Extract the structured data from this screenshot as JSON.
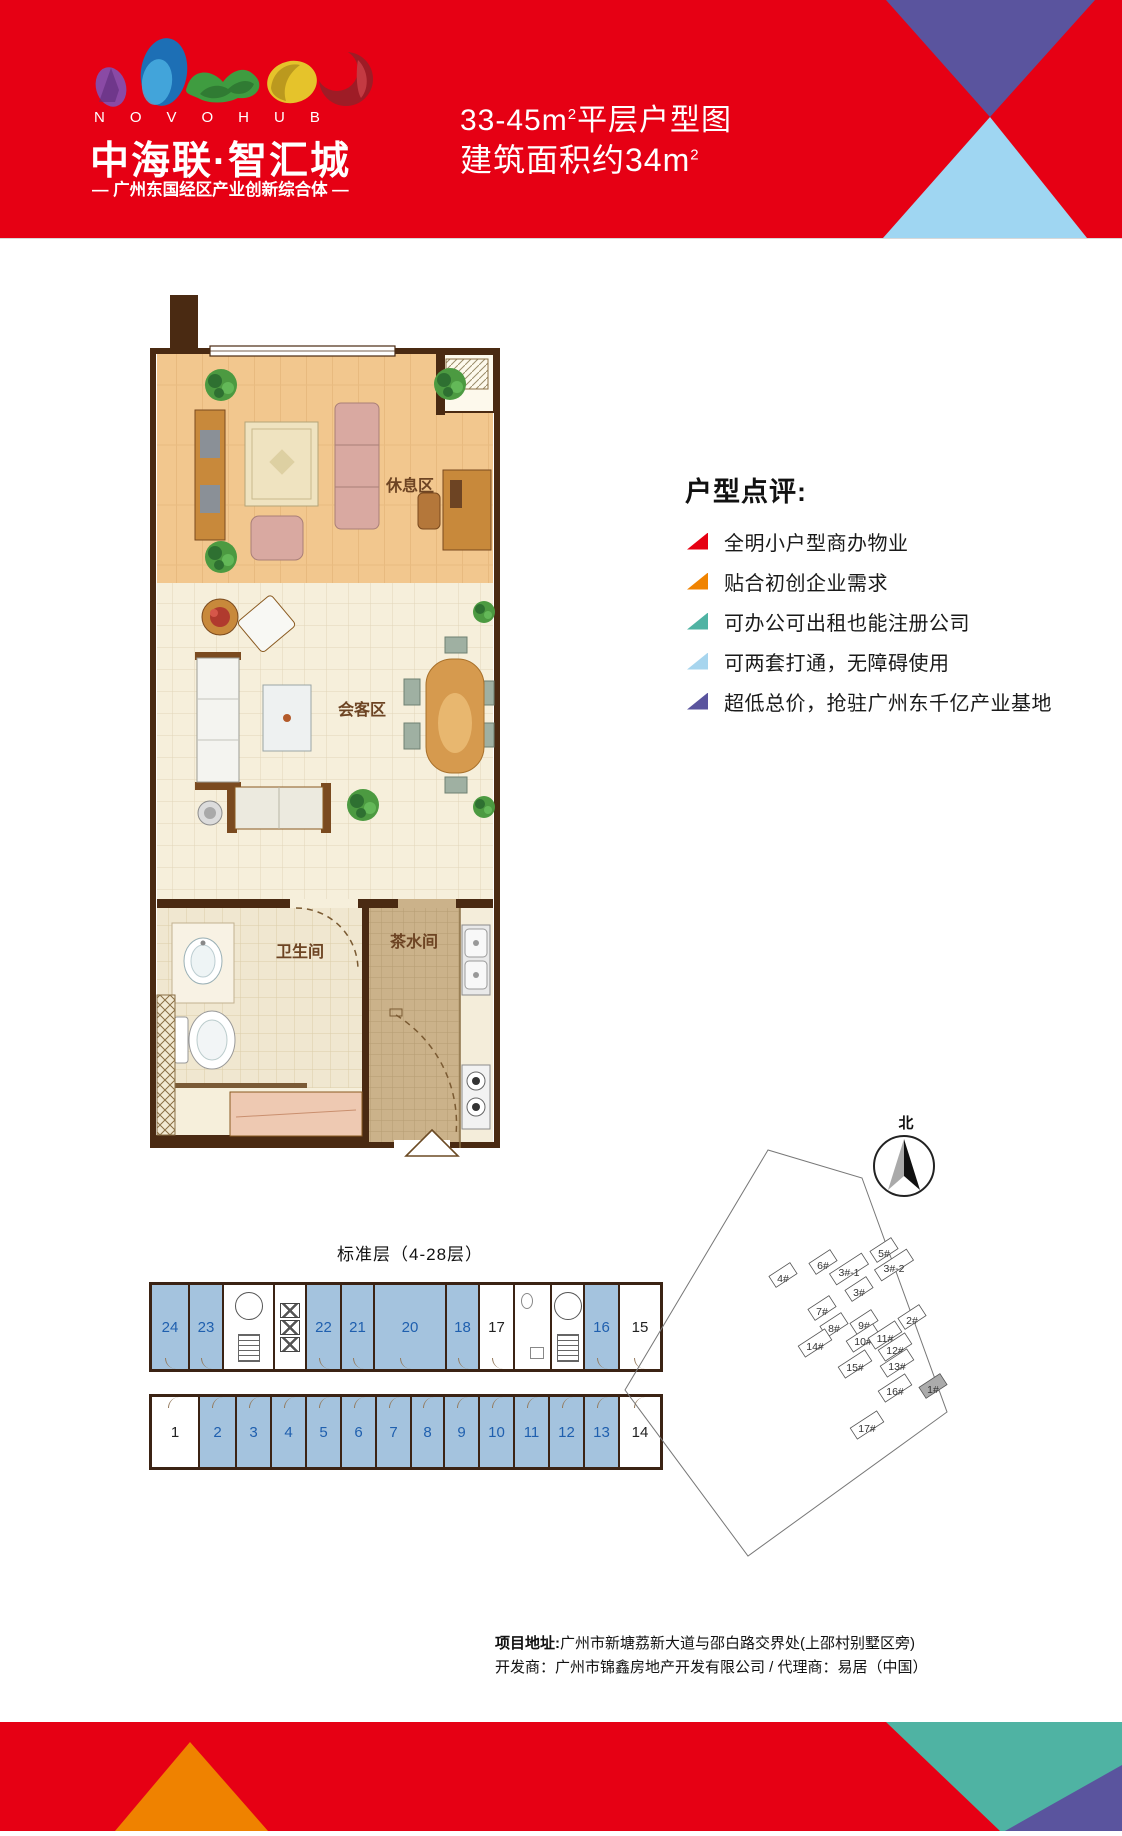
{
  "header": {
    "logo": {
      "letters": "NOVOHUB",
      "name": "中海联·智汇城",
      "tagline": "— 广州东国经区产业创新综合体 —"
    },
    "title": {
      "line1_text": "33-45m",
      "line1_sup": "2",
      "line1_tail": "平层户型图",
      "line2_text": "建筑面积约34m",
      "line2_sup": "2"
    }
  },
  "floor_plan": {
    "rooms": {
      "rest_area": "休息区",
      "meeting_area": "会客区",
      "bathroom": "卫生间",
      "tea_room": "茶水间"
    }
  },
  "comments": {
    "heading": "户型点评:",
    "items": [
      {
        "text": "全明小户型商办物业",
        "color": "#e60012"
      },
      {
        "text": "贴合初创企业需求",
        "color": "#f08300"
      },
      {
        "text": "可办公可出租也能注册公司",
        "color": "#4fb3a3"
      },
      {
        "text": "可两套打通，无障碍使用",
        "color": "#a7d5ee"
      },
      {
        "text": "超低总价，抢驻广州东千亿产业基地",
        "color": "#5a549e"
      }
    ]
  },
  "standard_floor": {
    "title": "标准层（4-28层）",
    "highlight_color": "#a4c3de",
    "number_color": "#1f5fae",
    "top_units": [
      {
        "no": "24",
        "highlight": true
      },
      {
        "no": "23",
        "highlight": true
      },
      {
        "no": "22",
        "highlight": true
      },
      {
        "no": "21",
        "highlight": true
      },
      {
        "no": "20",
        "highlight": true
      },
      {
        "no": "18",
        "highlight": true
      },
      {
        "no": "17",
        "highlight": false
      },
      {
        "no": "16",
        "highlight": true
      },
      {
        "no": "15",
        "highlight": false
      }
    ],
    "bottom_units": [
      {
        "no": "1",
        "highlight": false
      },
      {
        "no": "2",
        "highlight": true
      },
      {
        "no": "3",
        "highlight": true
      },
      {
        "no": "4",
        "highlight": true
      },
      {
        "no": "5",
        "highlight": true
      },
      {
        "no": "6",
        "highlight": true
      },
      {
        "no": "7",
        "highlight": true
      },
      {
        "no": "8",
        "highlight": true
      },
      {
        "no": "9",
        "highlight": true
      },
      {
        "no": "10",
        "highlight": true
      },
      {
        "no": "11",
        "highlight": true
      },
      {
        "no": "12",
        "highlight": true
      },
      {
        "no": "13",
        "highlight": true
      },
      {
        "no": "14",
        "highlight": false
      }
    ]
  },
  "site_plan": {
    "north_label": "北",
    "buildings": [
      {
        "name": "4#",
        "x": 783,
        "y": 1279
      },
      {
        "name": "6#",
        "x": 823,
        "y": 1266
      },
      {
        "name": "3#-1",
        "x": 849,
        "y": 1273
      },
      {
        "name": "5#",
        "x": 884,
        "y": 1254
      },
      {
        "name": "3#-2",
        "x": 894,
        "y": 1269
      },
      {
        "name": "3#",
        "x": 859,
        "y": 1293
      },
      {
        "name": "7#",
        "x": 822,
        "y": 1312
      },
      {
        "name": "2#",
        "x": 912,
        "y": 1321
      },
      {
        "name": "8#",
        "x": 834,
        "y": 1329
      },
      {
        "name": "9#",
        "x": 864,
        "y": 1326
      },
      {
        "name": "10#",
        "x": 863,
        "y": 1342
      },
      {
        "name": "11#",
        "x": 885,
        "y": 1339
      },
      {
        "name": "12#",
        "x": 895,
        "y": 1351
      },
      {
        "name": "14#",
        "x": 815,
        "y": 1347
      },
      {
        "name": "15#",
        "x": 855,
        "y": 1368
      },
      {
        "name": "13#",
        "x": 897,
        "y": 1367
      },
      {
        "name": "16#",
        "x": 895,
        "y": 1392
      },
      {
        "name": "1#",
        "x": 933,
        "y": 1390,
        "highlight": true
      },
      {
        "name": "17#",
        "x": 867,
        "y": 1429
      }
    ]
  },
  "footer": {
    "address_label": "项目地址:",
    "address": "广州市新塘荔新大道与邵白路交界处(上邵村别墅区旁)",
    "developer_line": "开发商：广州市锦鑫房地产开发有限公司  /  代理商：易居（中国）"
  }
}
